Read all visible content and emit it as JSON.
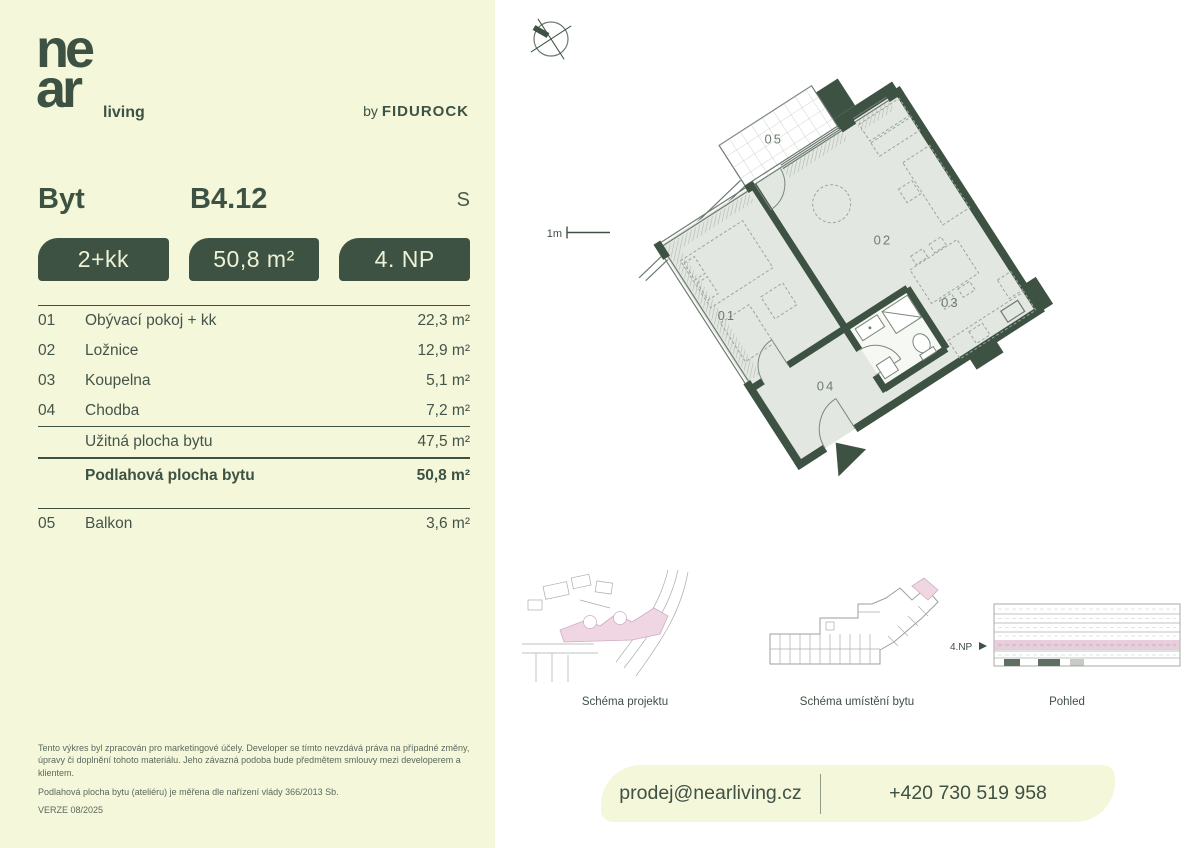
{
  "brand": {
    "logo_line1": "ne",
    "logo_line2": "ar",
    "logo_suffix": "living",
    "byline_prefix": "by",
    "byline_name": "FIDUROCK"
  },
  "header": {
    "type_label": "Byt",
    "unit_id": "B4.12",
    "orientation": "S"
  },
  "badges": [
    {
      "label": "2+kk"
    },
    {
      "label": "50,8 m²"
    },
    {
      "label": "4. NP"
    }
  ],
  "room_table": {
    "rows": [
      {
        "num": "01",
        "name": "Obývací pokoj + kk",
        "area": "22,3 m²"
      },
      {
        "num": "02",
        "name": "Ložnice",
        "area": "12,9 m²"
      },
      {
        "num": "03",
        "name": "Koupelna",
        "area": "5,1 m²"
      },
      {
        "num": "04",
        "name": "Chodba",
        "area": "7,2 m²"
      }
    ],
    "usable_label": "Užitná plocha bytu",
    "usable_area": "47,5 m²",
    "floor_label": "Podlahová plocha bytu",
    "floor_area": "50,8 m²",
    "extra": {
      "num": "05",
      "name": "Balkon",
      "area": "3,6 m²"
    }
  },
  "plan": {
    "scale_label": "1m",
    "room_labels": {
      "r01": "01",
      "r02": "02",
      "r03": "03",
      "r04": "04",
      "r05": "05"
    }
  },
  "schematics": {
    "project_caption": "Schéma projektu",
    "location_caption": "Schéma umístění bytu",
    "elevation_caption": "Pohled",
    "floor_marker": "4.NP"
  },
  "legal": {
    "paragraph1": "Tento výkres byl zpracován pro marketingové účely. Developer se tímto nevzdává práva na případné změny, úpravy či doplnění tohoto materiálu. Jeho závazná podoba bude předmětem smlouvy mezi developerem a klientem.",
    "paragraph2": "Podlahová plocha bytu (ateliéru) je měřena dle nařízení vlády 366/2013 Sb.",
    "version": "VERZE 08/2025"
  },
  "contact": {
    "email": "prodej@nearliving.cz",
    "phone": "+420 730 519 958"
  },
  "colors": {
    "background_panel": "#f4f7d9",
    "primary_green": "#3d5243",
    "floor_fill": "#e3e7e1",
    "highlight_pink": "#f0d5e3"
  }
}
